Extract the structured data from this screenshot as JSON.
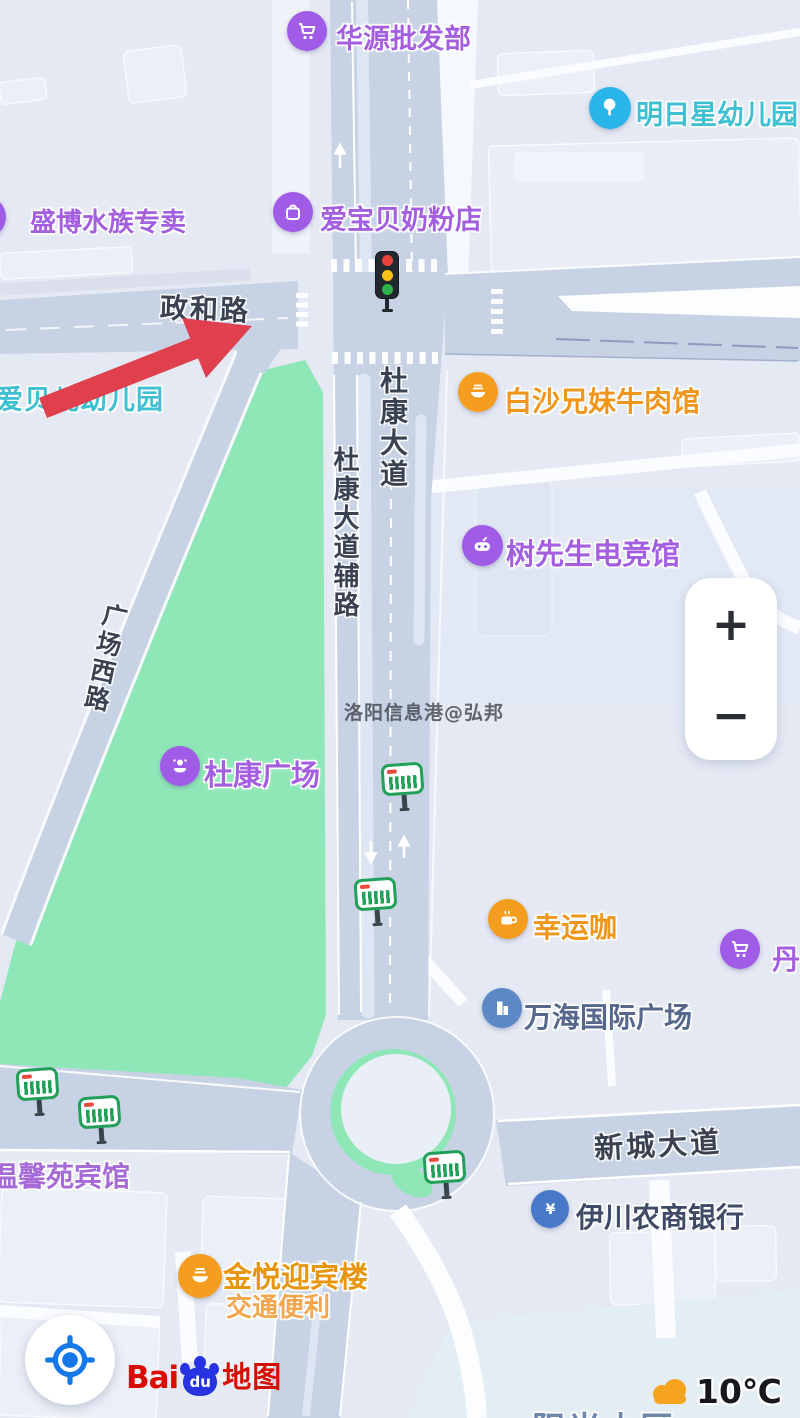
{
  "map": {
    "watermark": "洛阳信息港@弘邦",
    "roads": {
      "zhenghe": "政和路",
      "dukang": "杜康大道",
      "dukang_fulu": "杜康大道辅路",
      "guangchang_xilu": "广场西路",
      "xincheng": "新城大道"
    },
    "pois": {
      "huayuan": {
        "label": "华源批发部"
      },
      "mingri": {
        "label": "明日星幼儿园"
      },
      "shengbo": {
        "label": "盛博水族专卖"
      },
      "aibaobei": {
        "label": "爱宝贝奶粉店"
      },
      "aibeier": {
        "label": "爱贝儿幼儿园"
      },
      "baisha": {
        "label": "白沙兄妹牛肉馆"
      },
      "shuxiansheng": {
        "label": "树先生电竞馆"
      },
      "dukang_guangchang": {
        "label": "杜康广场"
      },
      "xingyunka": {
        "label": "幸运咖"
      },
      "dan": {
        "label": "丹"
      },
      "wanhai": {
        "label": "万海国际广场"
      },
      "wenxinyuan": {
        "label": "温馨苑宾馆"
      },
      "yichuan_bank": {
        "label": "伊川农商银行"
      },
      "jinyue": {
        "label": "金悦迎宾楼",
        "subtitle": "交通便利"
      },
      "yangguang": {
        "label": "阳光小区"
      }
    },
    "colors": {
      "poi_purple": "#a05ce6",
      "poi_orange": "#f49d1f",
      "poi_blue": "#5c88c6",
      "poi_cyan": "#29b5e8",
      "park_green": "#8fe7b7",
      "road_fill": "#c7d2e5",
      "arrow_red": "#e0404d"
    }
  },
  "controls": {
    "zoom_in": "+",
    "zoom_out": "−"
  },
  "branding": {
    "bai": "Bai",
    "du": "du",
    "ditu": "地图"
  },
  "weather": {
    "temperature": "10℃"
  }
}
